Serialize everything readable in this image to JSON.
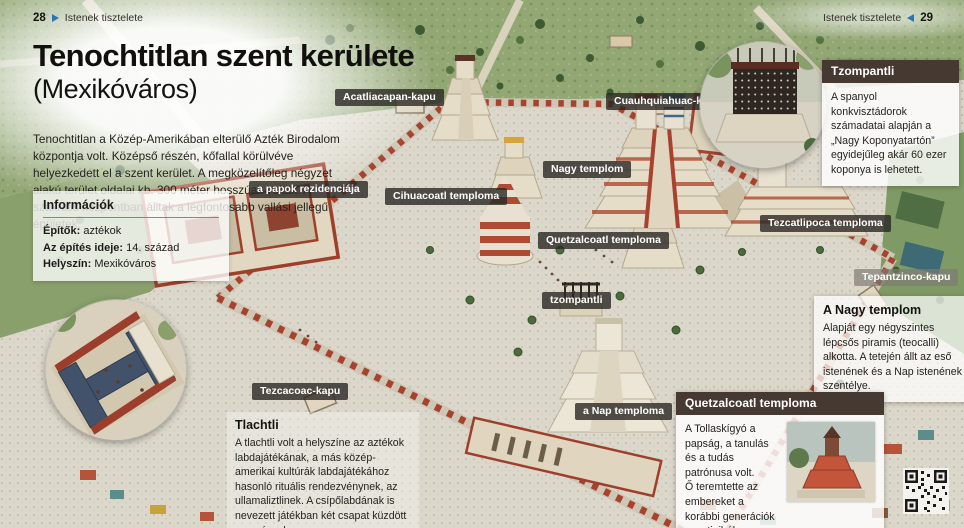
{
  "page_header": {
    "left": {
      "page_number": "28",
      "section_title": "Istenek tisztelete"
    },
    "right": {
      "page_number": "29",
      "section_title": "Istenek tisztelete"
    }
  },
  "title": {
    "main": "Tenochtitlan szent kerülete",
    "subtitle": "(Mexikóváros)"
  },
  "intro_text": "Tenochtitlan a Közép-Amerikában elterülő Azték Birodalom központja volt. Középső részén, kőfallal körülvéve helyezkedett el a szent kerület. A megközelítőleg négyzet alakú terület oldalai kb. 300 méter hosszúak voltak. A szakrális központban álltak a legfontosabb vallási jellegű épületek.",
  "info_box": {
    "title": "Információk",
    "rows": [
      {
        "label": "Építők:",
        "value": " aztékok"
      },
      {
        "label": "Az építés ideje:",
        "value": " 14. század"
      },
      {
        "label": "Helyszín:",
        "value": " Mexikóváros"
      }
    ]
  },
  "map_labels": [
    {
      "text": "Acatliacapan-kapu"
    },
    {
      "text": "Cuauhquiahuac-kapu"
    },
    {
      "text": "a papok rezidenciája"
    },
    {
      "text": "Cihuacoatl temploma"
    },
    {
      "text": "Nagy templom"
    },
    {
      "text": "Quetzalcoatl temploma"
    },
    {
      "text": "tzompantli"
    },
    {
      "text": "Tezcatlipoca temploma"
    },
    {
      "text": "Tepantzinco-kapu"
    },
    {
      "text": "Tezcacoac-kapu"
    },
    {
      "text": "a Nap temploma"
    }
  ],
  "callouts": {
    "tzompantli": {
      "title": "Tzompantli",
      "body": "A spanyol konkvisztádorok számadatai alapján a „Nagy Koponyatartón” egyidejűleg akár 60 ezer koponya is lehetett."
    },
    "nagy_templom": {
      "title": "A Nagy templom",
      "body": "Alapját egy négyszintes lépcsős piramis (teocalli) alkotta. A tetején állt az eső istenének és a Nap istenének a szentélye."
    },
    "quetzalcoatl_temploma": {
      "title": "Quetzalcoatl temploma",
      "body": "A Tollaskígyó a papság, a tanulás és a tudás patrónusa volt.\nŐ teremtette az embereket a korábbi generációk csontjaiból."
    },
    "tlachtli": {
      "title": "Tlachtli",
      "body": "A tlachtli volt a helyszíne az aztékok labdajátékának, a más közép-amerikai kultúrák labdajátékához hasonló rituális rendezvénynek, az ullamaliztlinek. A csípőlabdának is nevezett játékban két csapat küzdött egymással."
    }
  },
  "colors": {
    "accent_red": "#a7422e",
    "callout_header_brown": "#463931",
    "nav_arrow_blue": "#2f72b8",
    "label_background": "rgba(42,40,36,0.8)"
  }
}
